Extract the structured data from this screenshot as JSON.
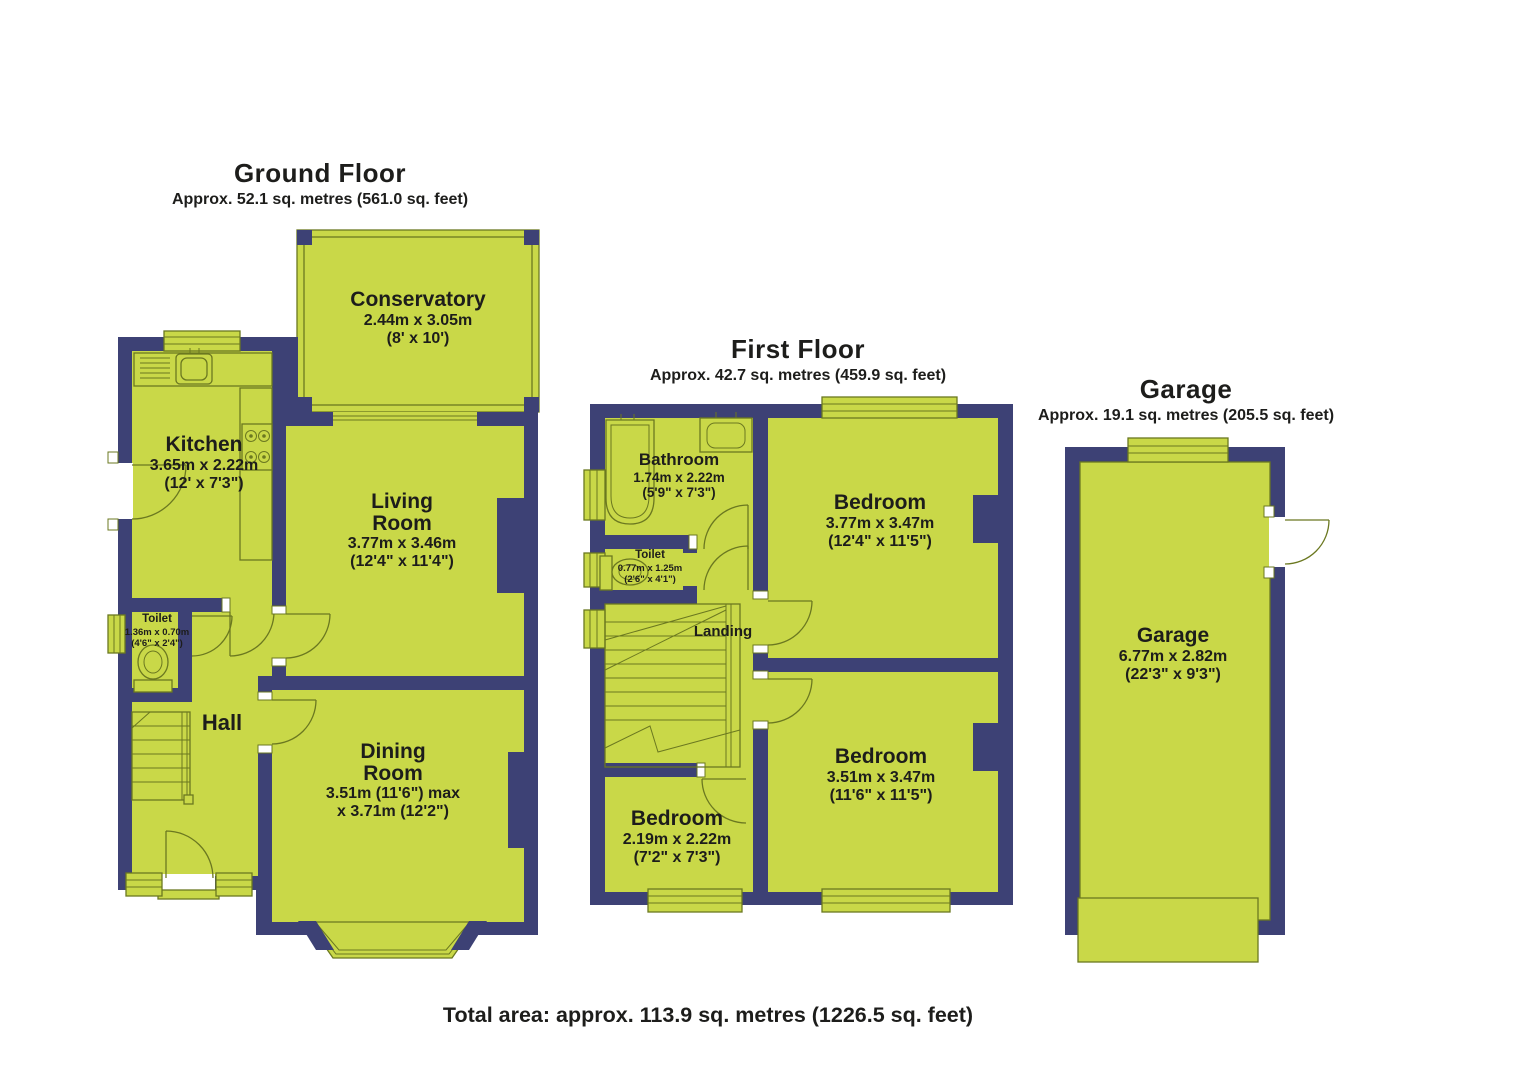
{
  "colors": {
    "wall": "#3d4175",
    "room": "#c9d848",
    "line": "#6b7820",
    "text": "#1d1d1b",
    "background": "#ffffff"
  },
  "ground_floor": {
    "title": "Ground Floor",
    "subtitle": "Approx. 52.1 sq. metres (561.0 sq. feet)",
    "rooms": {
      "conservatory": {
        "name": "Conservatory",
        "dims": "2.44m x 3.05m\n(8' x 10')"
      },
      "kitchen": {
        "name": "Kitchen",
        "dims": "3.65m x 2.22m\n(12' x 7'3\")"
      },
      "living_room": {
        "name": "Living\nRoom",
        "dims": "3.77m x 3.46m\n(12'4\" x 11'4\")"
      },
      "toilet": {
        "name": "Toilet",
        "dims": "1.36m x 0.70m\n(4'6\" x 2'4\")"
      },
      "hall": {
        "name": "Hall"
      },
      "dining_room": {
        "name": "Dining\nRoom",
        "dims": "3.51m (11'6\") max\nx 3.71m (12'2\")"
      }
    }
  },
  "first_floor": {
    "title": "First Floor",
    "subtitle": "Approx. 42.7 sq. metres (459.9 sq. feet)",
    "rooms": {
      "bathroom": {
        "name": "Bathroom",
        "dims": "1.74m x 2.22m\n(5'9\" x 7'3\")"
      },
      "toilet": {
        "name": "Toilet",
        "dims": "0.77m x 1.25m\n(2'6\" x 4'1\")"
      },
      "landing": {
        "name": "Landing"
      },
      "bedroom_front": {
        "name": "Bedroom",
        "dims": "3.77m x 3.47m\n(12'4\" x 11'5\")"
      },
      "bedroom_rear": {
        "name": "Bedroom",
        "dims": "3.51m x 3.47m\n(11'6\" x 11'5\")"
      },
      "bedroom_small": {
        "name": "Bedroom",
        "dims": "2.19m x 2.22m\n(7'2\" x 7'3\")"
      }
    }
  },
  "garage": {
    "title": "Garage",
    "subtitle": "Approx. 19.1 sq. metres (205.5 sq. feet)",
    "room": {
      "name": "Garage",
      "dims": "6.77m x 2.82m\n(22'3\" x 9'3\")"
    }
  },
  "footer": {
    "total_area": "Total area: approx. 113.9 sq. metres (1226.5 sq. feet)"
  }
}
